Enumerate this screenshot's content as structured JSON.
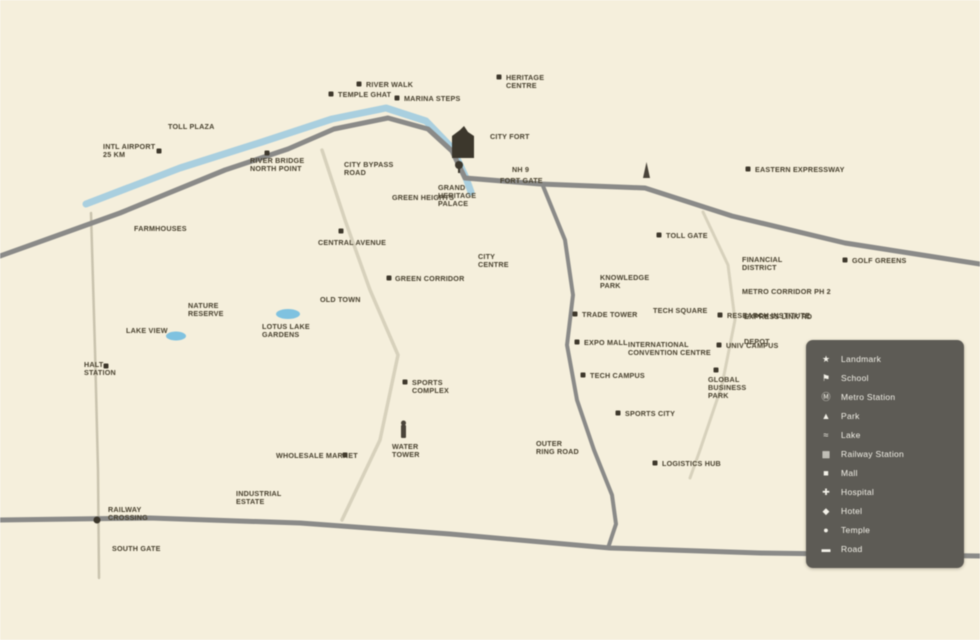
{
  "canvas": {
    "width": 980,
    "height": 640,
    "background": "#f5efdc"
  },
  "colors": {
    "road_major": "#898j",
    "major_road": "#8a8a88",
    "minor_road": "#d7d1bc",
    "rail_line": "#c9c3ae",
    "river": "#a9cfdf",
    "lake": "#7fc2e0",
    "label_text": "#48412f",
    "marker": "#3e382c",
    "legend_bg": "#5d5b55",
    "legend_text": "#f3f1e8"
  },
  "map": {
    "river": {
      "name": "river",
      "points": [
        [
          86,
          204
        ],
        [
          180,
          168
        ],
        [
          262,
          142
        ],
        [
          332,
          119
        ],
        [
          386,
          108
        ],
        [
          426,
          121
        ],
        [
          452,
          148
        ],
        [
          466,
          178
        ],
        [
          471,
          192
        ]
      ]
    },
    "roads": [
      {
        "name": "west-highway",
        "type": "major",
        "width": 5,
        "points": [
          [
            0,
            256
          ],
          [
            120,
            213
          ],
          [
            225,
            170
          ],
          [
            288,
            149
          ],
          [
            334,
            129
          ],
          [
            388,
            118
          ],
          [
            428,
            129
          ],
          [
            452,
            151
          ],
          [
            465,
            178
          ]
        ]
      },
      {
        "name": "east-highway",
        "type": "major",
        "width": 5,
        "points": [
          [
            465,
            178
          ],
          [
            540,
            184
          ],
          [
            645,
            188
          ],
          [
            732,
            216
          ],
          [
            845,
            243
          ],
          [
            980,
            264
          ]
        ]
      },
      {
        "name": "central-road",
        "type": "major",
        "width": 4,
        "points": [
          [
            543,
            186
          ],
          [
            565,
            240
          ],
          [
            573,
            295
          ],
          [
            567,
            345
          ],
          [
            577,
            400
          ],
          [
            594,
            450
          ],
          [
            612,
            495
          ],
          [
            616,
            524
          ],
          [
            608,
            548
          ]
        ]
      },
      {
        "name": "south-road",
        "type": "major",
        "width": 5,
        "points": [
          [
            0,
            520
          ],
          [
            150,
            518
          ],
          [
            300,
            523
          ],
          [
            450,
            534
          ],
          [
            610,
            548
          ],
          [
            760,
            553
          ],
          [
            980,
            556
          ]
        ]
      },
      {
        "name": "rail-corridor",
        "type": "rail",
        "width": 2.5,
        "points": [
          [
            91,
            213
          ],
          [
            95,
            350
          ],
          [
            98,
            470
          ],
          [
            99,
            578
          ]
        ]
      },
      {
        "name": "inner-link-road",
        "type": "minor",
        "width": 3.5,
        "points": [
          [
            322,
            150
          ],
          [
            345,
            220
          ],
          [
            370,
            290
          ],
          [
            398,
            355
          ],
          [
            380,
            440
          ],
          [
            342,
            520
          ]
        ]
      },
      {
        "name": "east-link-road",
        "type": "minor",
        "width": 3,
        "points": [
          [
            703,
            212
          ],
          [
            728,
            265
          ],
          [
            735,
            320
          ],
          [
            722,
            385
          ],
          [
            700,
            450
          ],
          [
            690,
            478
          ]
        ]
      }
    ],
    "lakes": [
      {
        "name": "west-lake",
        "cx": 176,
        "cy": 336,
        "rx": 10,
        "ry": 4.5
      },
      {
        "name": "central-lake",
        "cx": 288,
        "cy": 314,
        "rx": 12,
        "ry": 5
      }
    ],
    "landmarks": [
      {
        "name": "fort-building",
        "type": "building",
        "x": 452,
        "y": 126
      },
      {
        "name": "junction-pin",
        "type": "pin",
        "x": 459,
        "y": 165
      },
      {
        "name": "monument-obelisk",
        "type": "monument",
        "x": 643,
        "y": 162
      },
      {
        "name": "water-tower",
        "type": "tower",
        "x": 401,
        "y": 425
      },
      {
        "name": "rail-crossing-dot",
        "type": "dot",
        "x": 97,
        "y": 520
      }
    ],
    "labels": [
      {
        "x": 338,
        "y": 97,
        "lines": [
          "TEMPLE GHAT"
        ],
        "marker": [
          331,
          94
        ]
      },
      {
        "x": 366,
        "y": 87,
        "lines": [
          "RIVER WALK"
        ],
        "marker": [
          359,
          84
        ]
      },
      {
        "x": 404,
        "y": 101,
        "lines": [
          "MARINA STEPS"
        ],
        "marker": [
          397,
          98
        ]
      },
      {
        "x": 506,
        "y": 80,
        "lines": [
          "HERITAGE",
          "CENTRE"
        ],
        "marker": [
          499,
          77
        ]
      },
      {
        "x": 168,
        "y": 129,
        "lines": [
          "TOLL PLAZA"
        ]
      },
      {
        "x": 103,
        "y": 149,
        "lines": [
          "INTL AIRPORT",
          "25 KM"
        ],
        "marker": [
          159,
          151
        ]
      },
      {
        "x": 250,
        "y": 163,
        "lines": [
          "RIVER BRIDGE",
          "NORTH POINT"
        ],
        "marker": [
          267,
          153
        ]
      },
      {
        "x": 344,
        "y": 167,
        "lines": [
          "CITY BYPASS",
          "ROAD"
        ]
      },
      {
        "x": 392,
        "y": 200,
        "lines": [
          "GREEN HEIGHTS"
        ]
      },
      {
        "x": 318,
        "y": 245,
        "lines": [
          "CENTRAL AVENUE"
        ],
        "marker": [
          341,
          231
        ]
      },
      {
        "x": 395,
        "y": 281,
        "lines": [
          "GREEN CORRIDOR"
        ],
        "marker": [
          389,
          278
        ]
      },
      {
        "x": 320,
        "y": 302,
        "lines": [
          "OLD TOWN"
        ]
      },
      {
        "x": 134,
        "y": 231,
        "lines": [
          "FARMHOUSES"
        ]
      },
      {
        "x": 188,
        "y": 308,
        "lines": [
          "NATURE",
          "RESERVE"
        ]
      },
      {
        "x": 126,
        "y": 333,
        "lines": [
          "LAKE VIEW"
        ]
      },
      {
        "x": 262,
        "y": 329,
        "lines": [
          "LOTUS LAKE",
          "GARDENS"
        ]
      },
      {
        "x": 84,
        "y": 367,
        "lines": [
          "HALT",
          "STATION"
        ],
        "marker": [
          106,
          366
        ]
      },
      {
        "x": 108,
        "y": 512,
        "lines": [
          "RAILWAY",
          "CROSSING"
        ]
      },
      {
        "x": 112,
        "y": 551,
        "lines": [
          "SOUTH GATE"
        ]
      },
      {
        "x": 236,
        "y": 496,
        "lines": [
          "INDUSTRIAL",
          "ESTATE"
        ]
      },
      {
        "x": 276,
        "y": 458,
        "lines": [
          "WHOLESALE MARKET"
        ],
        "marker": [
          345,
          455
        ]
      },
      {
        "x": 412,
        "y": 385,
        "lines": [
          "SPORTS",
          "COMPLEX"
        ],
        "marker": [
          405,
          382
        ]
      },
      {
        "x": 392,
        "y": 449,
        "lines": [
          "WATER",
          "TOWER"
        ]
      },
      {
        "x": 478,
        "y": 259,
        "lines": [
          "CITY",
          "CENTRE"
        ]
      },
      {
        "x": 438,
        "y": 190,
        "lines": [
          "GRAND",
          "HERITAGE",
          "PALACE"
        ]
      },
      {
        "x": 490,
        "y": 139,
        "lines": [
          "CITY FORT"
        ]
      },
      {
        "x": 500,
        "y": 183,
        "lines": [
          "FORT GATE"
        ]
      },
      {
        "x": 512,
        "y": 172,
        "lines": [
          "NH 9"
        ]
      },
      {
        "x": 600,
        "y": 280,
        "lines": [
          "KNOWLEDGE",
          "PARK"
        ]
      },
      {
        "x": 653,
        "y": 313,
        "lines": [
          "TECH SQUARE"
        ]
      },
      {
        "x": 582,
        "y": 317,
        "lines": [
          "TRADE TOWER"
        ],
        "marker": [
          575,
          314
        ]
      },
      {
        "x": 584,
        "y": 345,
        "lines": [
          "EXPO MALL"
        ],
        "marker": [
          577,
          342
        ]
      },
      {
        "x": 590,
        "y": 378,
        "lines": [
          "TECH CAMPUS"
        ],
        "marker": [
          583,
          375
        ]
      },
      {
        "x": 628,
        "y": 347,
        "lines": [
          "INTERNATIONAL",
          "CONVENTION CENTRE"
        ]
      },
      {
        "x": 727,
        "y": 318,
        "lines": [
          "RESEARCH INSTITUTE"
        ],
        "marker": [
          720,
          315
        ]
      },
      {
        "x": 726,
        "y": 348,
        "lines": [
          "UNIV CAMPUS"
        ],
        "marker": [
          719,
          345
        ]
      },
      {
        "x": 708,
        "y": 382,
        "lines": [
          "GLOBAL",
          "BUSINESS",
          "PARK"
        ],
        "marker": [
          716,
          370
        ]
      },
      {
        "x": 742,
        "y": 262,
        "lines": [
          "FINANCIAL",
          "DISTRICT"
        ]
      },
      {
        "x": 742,
        "y": 294,
        "lines": [
          "METRO CORRIDOR PH 2"
        ]
      },
      {
        "x": 744,
        "y": 319,
        "lines": [
          "EXPRESS LINK RD"
        ]
      },
      {
        "x": 744,
        "y": 344,
        "lines": [
          "DEPOT"
        ]
      },
      {
        "x": 852,
        "y": 263,
        "lines": [
          "GOLF GREENS"
        ],
        "marker": [
          845,
          260
        ]
      },
      {
        "x": 755,
        "y": 172,
        "lines": [
          "EASTERN EXPRESSWAY"
        ],
        "marker": [
          748,
          169
        ]
      },
      {
        "x": 666,
        "y": 238,
        "lines": [
          "TOLL GATE"
        ],
        "marker": [
          659,
          235
        ]
      },
      {
        "x": 625,
        "y": 416,
        "lines": [
          "SPORTS CITY"
        ],
        "marker": [
          618,
          413
        ]
      },
      {
        "x": 662,
        "y": 466,
        "lines": [
          "LOGISTICS HUB"
        ],
        "marker": [
          655,
          463
        ]
      },
      {
        "x": 536,
        "y": 446,
        "lines": [
          "OUTER",
          "RING ROAD"
        ]
      }
    ]
  },
  "legend": {
    "x": 806,
    "y": 340,
    "width": 158,
    "height": 228,
    "items": [
      {
        "icon_name": "landmark-icon",
        "glyph": "★",
        "label": "Landmark"
      },
      {
        "icon_name": "school-icon",
        "glyph": "⚑",
        "label": "School"
      },
      {
        "icon_name": "metro-icon",
        "glyph": "Ⓜ",
        "label": "Metro Station"
      },
      {
        "icon_name": "park-icon",
        "glyph": "▲",
        "label": "Park"
      },
      {
        "icon_name": "lake-icon",
        "glyph": "≈",
        "label": "Lake"
      },
      {
        "icon_name": "railway-icon",
        "glyph": "▦",
        "label": "Railway Station"
      },
      {
        "icon_name": "mall-icon",
        "glyph": "■",
        "label": "Mall"
      },
      {
        "icon_name": "hospital-icon",
        "glyph": "✚",
        "label": "Hospital"
      },
      {
        "icon_name": "hotel-icon",
        "glyph": "◆",
        "label": "Hotel"
      },
      {
        "icon_name": "temple-icon",
        "glyph": "●",
        "label": "Temple"
      },
      {
        "icon_name": "road-icon",
        "glyph": "▬",
        "label": "Road"
      }
    ]
  }
}
